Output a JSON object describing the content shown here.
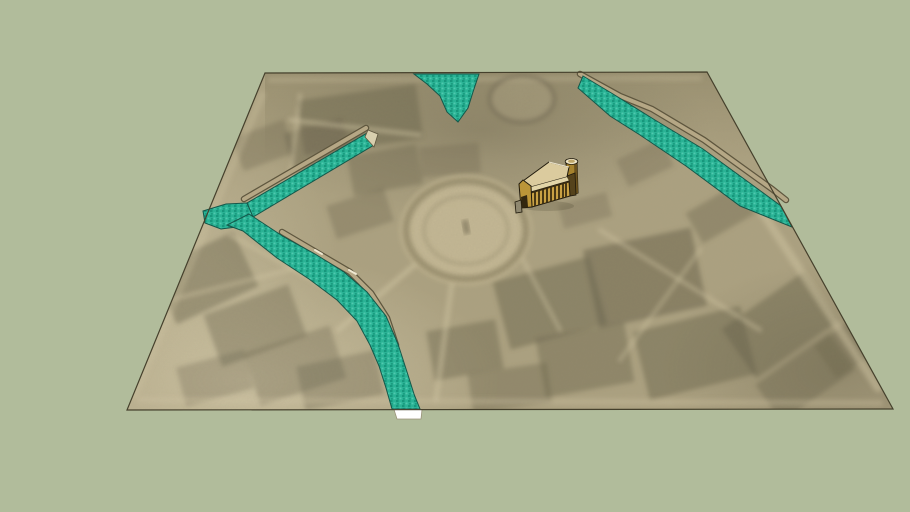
{
  "scene": {
    "viewer": "3d-model-viewport",
    "background_color": "#b1bc9b",
    "map": {
      "label": "historical-city-map-plane",
      "corner_top_left": [
        265,
        73
      ],
      "corner_top_right": [
        707,
        72
      ],
      "corner_bottom_right": [
        893,
        409
      ],
      "corner_bottom_left": [
        127,
        410
      ]
    },
    "model": {
      "label": "colonnaded-building-with-round-tower"
    },
    "colors": {
      "background": "#b1bc9b",
      "map_base": "#aba07f",
      "map_light": "#d2c7a6",
      "map_dark": "#6e6850",
      "map_edge": "#45402c",
      "water": "#2ab395",
      "water_dark": "#17977c",
      "water_light": "#4fc9ae",
      "water_edge": "#14574a",
      "embankment": "#b5a785",
      "embankment_edge": "#5e563e",
      "cut_face": "#ffffff",
      "plaza_fill": "#c6ba97",
      "plaza_ring": "#7e7557",
      "building_gold": "#c9a144",
      "building_gold_dark": "#a5822e",
      "building_shadow": "#55431c",
      "building_roof": "#dbcb9e",
      "building_trim": "#ece3c6",
      "building_outline": "#201a0c"
    }
  }
}
